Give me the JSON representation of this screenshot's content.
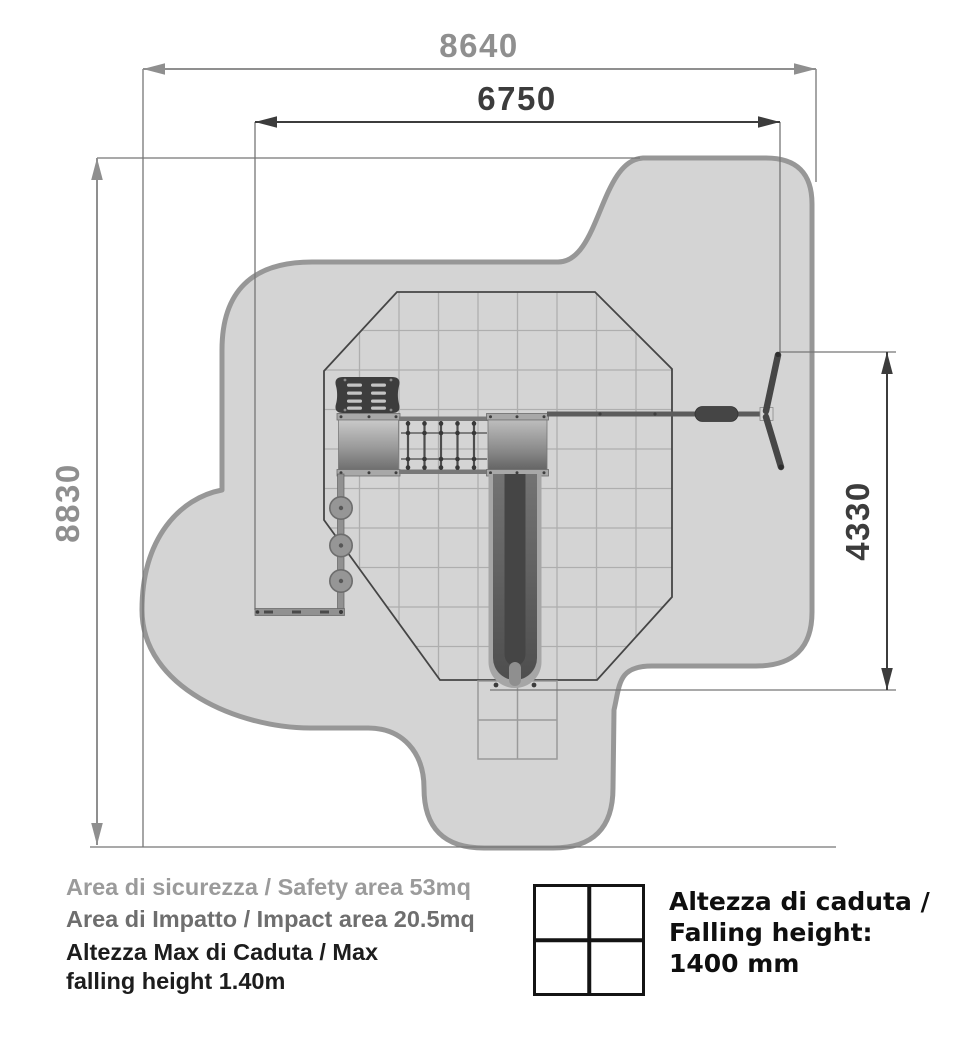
{
  "dimensions": {
    "total_width": "8640",
    "inner_width": "6750",
    "total_height": "8830",
    "inner_height": "4330"
  },
  "legend": {
    "safety_area": "Area di sicurezza / Safety area 53mq",
    "impact_area": "Area di Impatto / Impact area 20.5mq",
    "max_fall_line1": "Altezza Max di Caduta / Max",
    "max_fall_line2": "falling height 1.40m"
  },
  "falling_height_box": {
    "icon_name": "tile-grid-icon",
    "line1": "Altezza di caduta /",
    "line2": "Falling height:",
    "line3": "1400 mm"
  },
  "colors": {
    "safety_area_fill": "#d4d4d4",
    "safety_area_border": "#979797",
    "impact_area_outline": "#454545",
    "grid_line": "#aeaeae",
    "dimension_primary": "#8f8f8f",
    "dimension_secondary": "#3c3c3c",
    "equipment_dark": "#3d3d3d"
  }
}
